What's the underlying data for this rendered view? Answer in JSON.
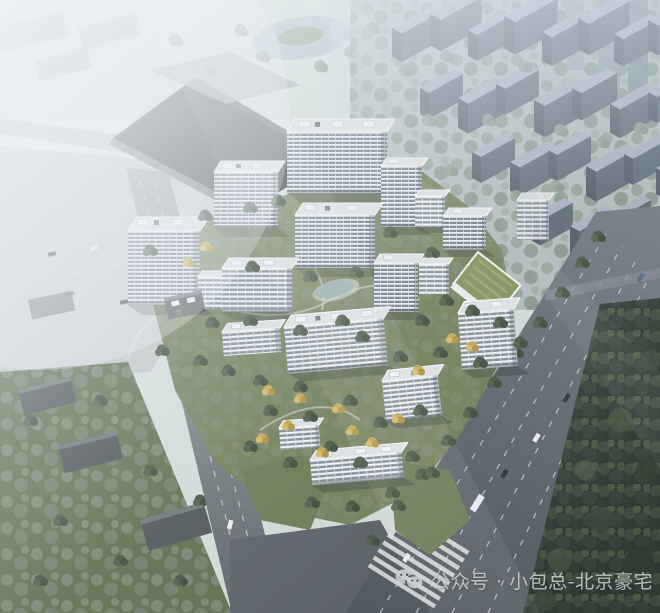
{
  "watermark": {
    "text": "公众号 · 小包总-北京豪宅",
    "icon": "wechat-logo",
    "color": "#ccd1d4"
  },
  "scene": {
    "type": "aerial-architecture-rendering",
    "palette": {
      "haze": "#eef3f7",
      "asphalt": "#565e65",
      "asphalt_light": "#79818a",
      "plaza": "#c2c7c8",
      "lawn": "#6d7b55",
      "lawn_dark": "#596a48",
      "forest": "#2c3830",
      "facade_white": "#eff1f2",
      "facade_glass": "#6c7a87",
      "roof": "#dcdfe1",
      "roof_edge": "#f6f7f8",
      "podium": "#34383c",
      "bg_city_face": "#57636f",
      "bg_city_roof": "#a2aebb",
      "tree_green": "#41513f",
      "tree_yellow": "#c3a54e",
      "tree_sage": "#8a9a8c",
      "water": "#a9bdc3",
      "pond": "#93a8a6",
      "lane_mark": "#d8dde0",
      "watermark_color": "#ccd1d4"
    }
  }
}
